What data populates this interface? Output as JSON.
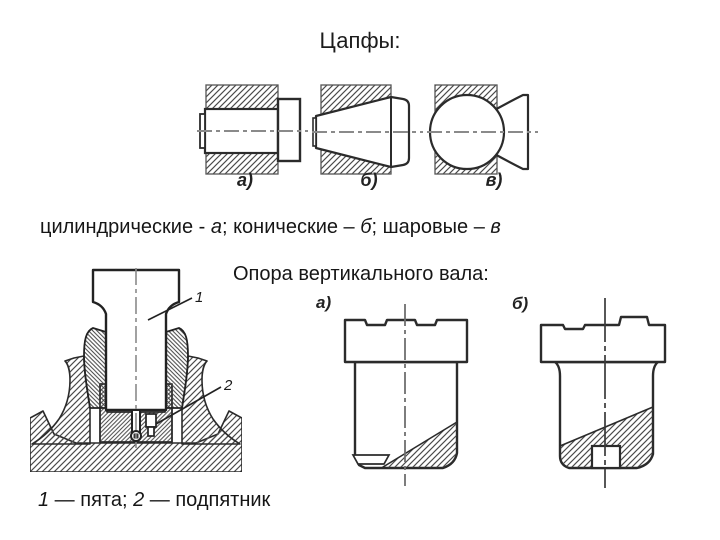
{
  "title": "Цапфы:",
  "top_figures": {
    "label_a": "а)",
    "label_b": "б)",
    "label_v": "в)"
  },
  "journal_caption": {
    "s1": "цилиндрические - ",
    "i1": "а",
    "s2": "; конические – ",
    "i2": "б",
    "s3": "; шаровые – ",
    "i3": "в"
  },
  "support_caption": "Опора вертикального вала:",
  "bottom_figures": {
    "label_a": "а)",
    "label_b": "б)"
  },
  "callouts": {
    "pivot": "1",
    "thrust_bearing": "2"
  },
  "legend": {
    "n1": "1",
    "t1": " — пята; ",
    "n2": "2",
    "t2": " — подпятник"
  },
  "colors": {
    "background": "#ffffff",
    "ink": "#1b1b1b",
    "outline": "#2b2b2b",
    "hatch": "#4a4a4a",
    "centerline": "#8a8a8a"
  }
}
